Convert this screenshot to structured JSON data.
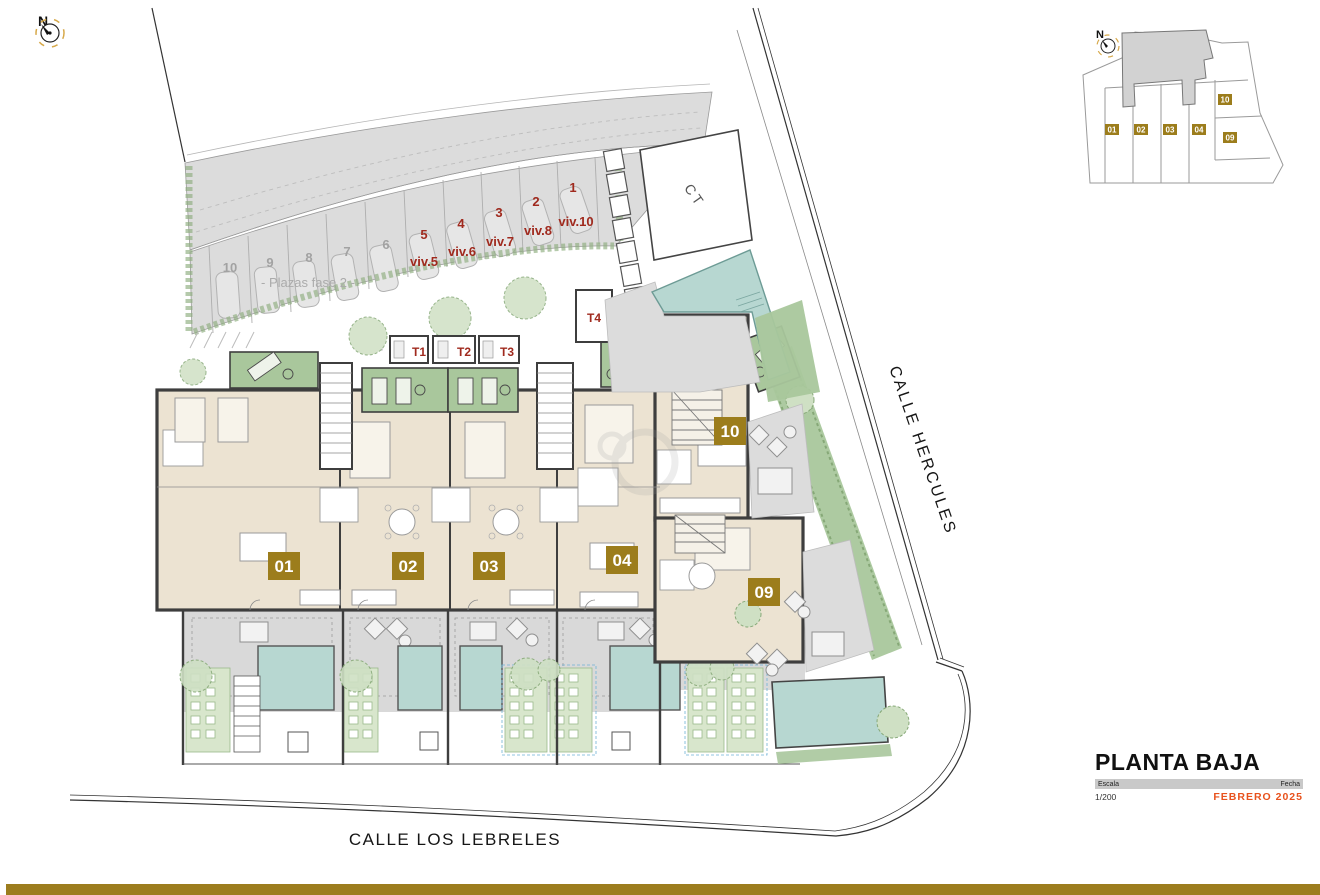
{
  "compass": {
    "label": "N"
  },
  "parking": {
    "phase_label": "- Plazas fase 2 -",
    "spaces_gray": [
      {
        "num": "10"
      },
      {
        "num": "9"
      },
      {
        "num": "8"
      },
      {
        "num": "7"
      },
      {
        "num": "6"
      }
    ],
    "spaces_red": [
      {
        "num": "5",
        "viv": "viv.5"
      },
      {
        "num": "4",
        "viv": "viv.6"
      },
      {
        "num": "3",
        "viv": "viv.7"
      },
      {
        "num": "2",
        "viv": "viv.8"
      },
      {
        "num": "1",
        "viv": "viv.10"
      }
    ]
  },
  "buildings": {
    "transformer": "CT",
    "storage": [
      "T1",
      "T2",
      "T3",
      "T4"
    ],
    "units": [
      {
        "id": "01"
      },
      {
        "id": "02"
      },
      {
        "id": "03"
      },
      {
        "id": "04"
      },
      {
        "id": "09"
      },
      {
        "id": "10"
      }
    ]
  },
  "streets": {
    "east": "CALLE HERCULES",
    "south": "CALLE LOS LEBRELES"
  },
  "keyplan": {
    "compass_label": "N",
    "units": [
      "01",
      "02",
      "03",
      "04",
      "09",
      "10"
    ]
  },
  "titleblock": {
    "title": "PLANTA BAJA",
    "scale_label": "Escala",
    "scale_value": "1/200",
    "date_label": "Fecha",
    "date_value": "FEBRERO 2025"
  },
  "colors": {
    "badge_gold": "#9c7d1c",
    "unit_red": "#a02a1e",
    "accent_date": "#e8521d",
    "bottom_bar": "#9c7d1e",
    "pool_teal": "#b7d7d1",
    "deck_green": "#a9c79c",
    "floor_beige": "#ece3d2",
    "paving_gray": "#d9d9d9",
    "wall_dark": "#3e3e3e"
  }
}
